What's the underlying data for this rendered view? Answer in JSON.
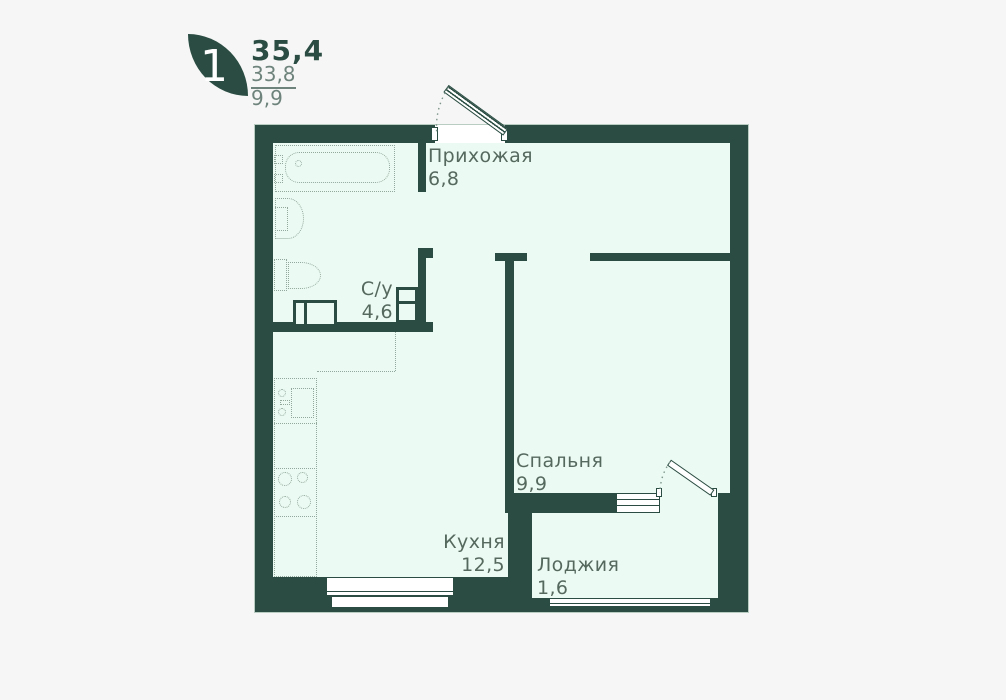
{
  "legend": {
    "rooms_count": "1",
    "total_area": "35,4",
    "living_area": "33,8",
    "kitchen_area": "9,9"
  },
  "rooms": {
    "hallway": {
      "name": "Прихожая",
      "area": "6,8"
    },
    "bathroom": {
      "name": "С/у",
      "area": "4,6"
    },
    "bedroom": {
      "name": "Спальня",
      "area": "9,9"
    },
    "kitchen": {
      "name": "Кухня",
      "area": "12,5"
    },
    "loggia": {
      "name": "Лоджия",
      "area": "1,6"
    }
  },
  "colors": {
    "wall": "#2a4c42",
    "floor": "#ebfbf3",
    "page_background": "#f5f6f5",
    "label_text": "#56695f",
    "fixture_line": "#93a89d",
    "legend_secondary": "#6e837b",
    "wall_outline": "#b9cdc3",
    "swing_arc": "#7d948a"
  }
}
